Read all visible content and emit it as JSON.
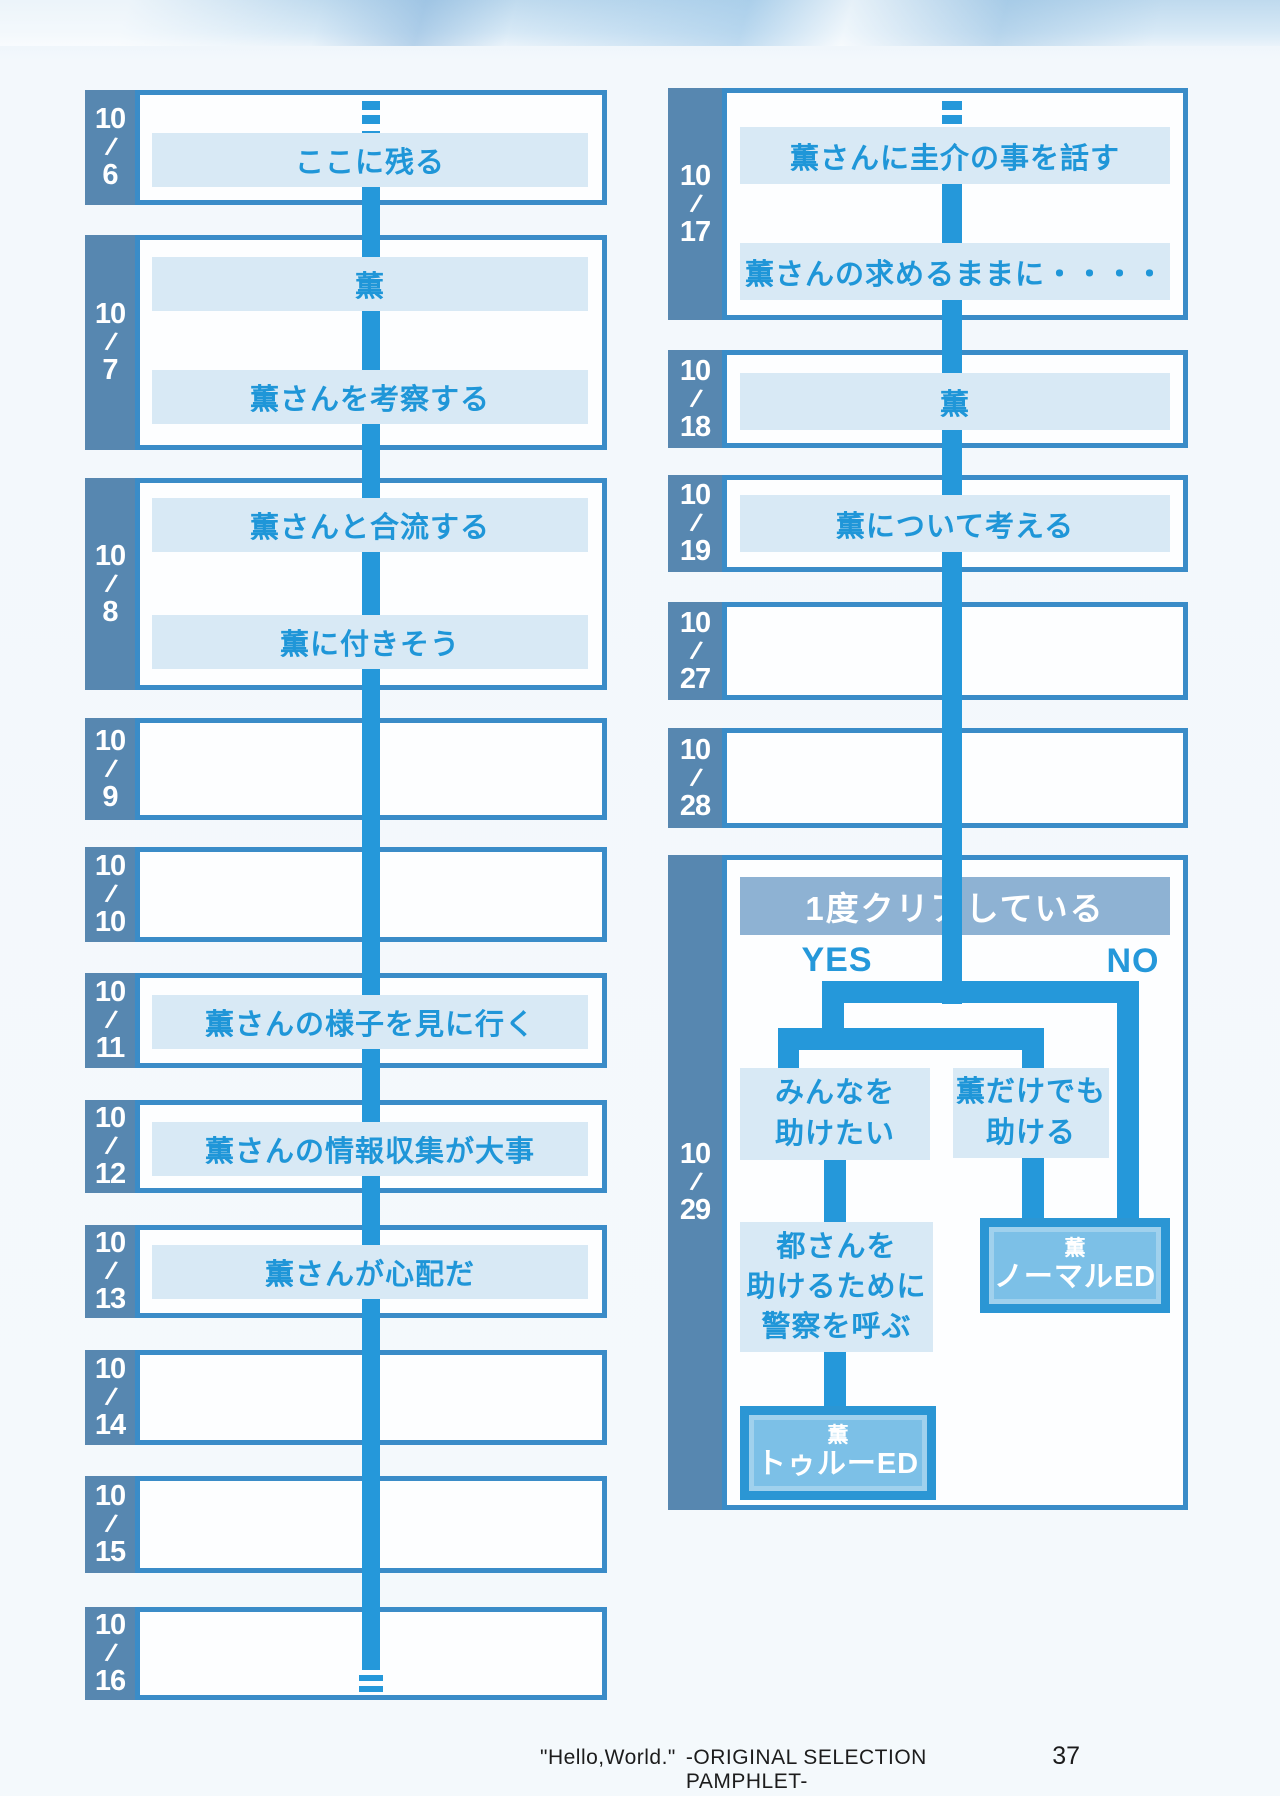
{
  "labels": {
    "date_slash": "/"
  },
  "colors": {
    "accent_line": "#2598da",
    "choice_band": "#d8e9f5",
    "choice_text": "#1f96d8",
    "date_tab": "#5787b0",
    "box_border": "#3a8cc8",
    "question_band": "#8eb2d3",
    "ending_fill": "#7cc0e7",
    "ending_border": "#2b96d4"
  },
  "left_column": {
    "boxes": [
      {
        "month": "10",
        "day": "6",
        "bands": [
          "ここに残る"
        ]
      },
      {
        "month": "10",
        "day": "7",
        "bands": [
          "薫",
          "薫さんを考察する"
        ]
      },
      {
        "month": "10",
        "day": "8",
        "bands": [
          "薫さんと合流する",
          "薫に付きそう"
        ]
      },
      {
        "month": "10",
        "day": "9",
        "bands": []
      },
      {
        "month": "10",
        "day": "10",
        "bands": []
      },
      {
        "month": "10",
        "day": "11",
        "bands": [
          "薫さんの様子を見に行く"
        ]
      },
      {
        "month": "10",
        "day": "12",
        "bands": [
          "薫さんの情報収集が大事"
        ]
      },
      {
        "month": "10",
        "day": "13",
        "bands": [
          "薫さんが心配だ"
        ]
      },
      {
        "month": "10",
        "day": "14",
        "bands": []
      },
      {
        "month": "10",
        "day": "15",
        "bands": []
      },
      {
        "month": "10",
        "day": "16",
        "bands": []
      }
    ]
  },
  "right_column": {
    "boxes": [
      {
        "month": "10",
        "day": "17",
        "bands": [
          "薫さんに圭介の事を話す",
          "薫さんの求めるままに・・・・"
        ]
      },
      {
        "month": "10",
        "day": "18",
        "bands": [
          "薫"
        ]
      },
      {
        "month": "10",
        "day": "19",
        "bands": [
          "薫について考える"
        ]
      },
      {
        "month": "10",
        "day": "27",
        "bands": []
      },
      {
        "month": "10",
        "day": "28",
        "bands": []
      }
    ],
    "final": {
      "month": "10",
      "day": "29"
    }
  },
  "decision": {
    "question": "1度クリアしている",
    "yes_label": "YES",
    "no_label": "NO",
    "choice_left_line1": "みんなを",
    "choice_left_line2": "助けたい",
    "choice_right_line1": "薫だけでも",
    "choice_right_line2": "助ける",
    "step_line1": "都さんを",
    "step_line2": "助けるために",
    "step_line3": "警察を呼ぶ",
    "ending_normal_line1": "薫",
    "ending_normal_line2": "ノーマルED",
    "ending_true_line1": "薫",
    "ending_true_line2": "トゥルーED"
  },
  "footer": {
    "quote": "\"Hello,World.\"",
    "label": "-ORIGINAL SELECTION PAMPHLET-",
    "page_number": "37"
  }
}
